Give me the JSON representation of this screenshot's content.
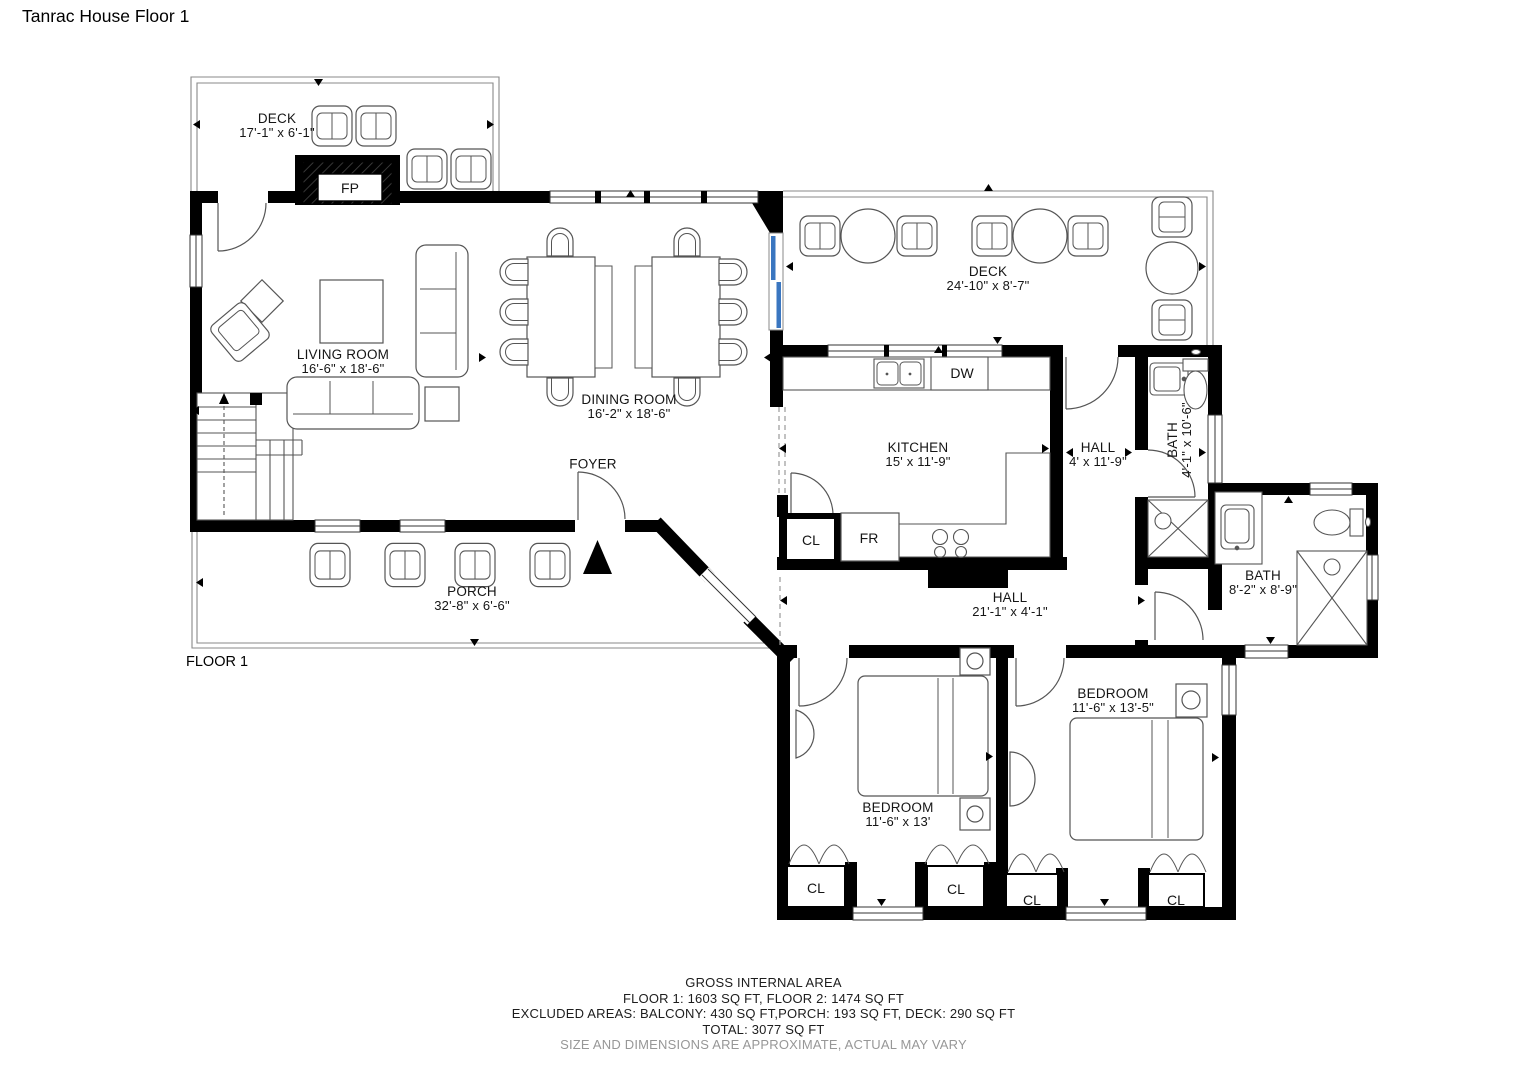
{
  "title": "Tanrac House Floor 1",
  "floor_label": "FLOOR 1",
  "rooms": {
    "deck_top": {
      "name": "DECK",
      "dims": "17'-1\" x 6'-1\""
    },
    "deck_right": {
      "name": "DECK",
      "dims": "24'-10\" x 8'-7\""
    },
    "living": {
      "name": "LIVING ROOM",
      "dims": "16'-6\" x 18'-6\""
    },
    "dining": {
      "name": "DINING ROOM",
      "dims": "16'-2\" x 18'-6\""
    },
    "kitchen": {
      "name": "KITCHEN",
      "dims": "15' x 11'-9\""
    },
    "hall_upper": {
      "name": "HALL",
      "dims": "4' x 11'-9\""
    },
    "bath_upper": {
      "name": "BATH",
      "dims": "4'-1\" x 10'-6\""
    },
    "bath_lower": {
      "name": "BATH",
      "dims": "8'-2\" x 8'-9\""
    },
    "foyer": {
      "name": "FOYER"
    },
    "porch": {
      "name": "PORCH",
      "dims": "32'-8\" x 6'-6\""
    },
    "hall_lower": {
      "name": "HALL",
      "dims": "21'-1\" x 4'-1\""
    },
    "bedroom_left": {
      "name": "BEDROOM",
      "dims": "11'-6\" x 13'"
    },
    "bedroom_right": {
      "name": "BEDROOM",
      "dims": "11'-6\" x 13'-5\""
    }
  },
  "fixtures": {
    "fireplace": "FP",
    "dishwasher": "DW",
    "fridge": "FR",
    "closet": "CL"
  },
  "footer": {
    "line1": "GROSS INTERNAL AREA",
    "line2": "FLOOR 1: 1603 SQ FT, FLOOR 2: 1474 SQ FT",
    "line3": "EXCLUDED AREAS: BALCONY: 430 SQ FT,PORCH: 193 SQ FT, DECK: 290 SQ FT",
    "line4": "TOTAL: 3077 SQ FT",
    "line5": "SIZE AND DIMENSIONS ARE APPROXIMATE, ACTUAL MAY VARY"
  },
  "colors": {
    "wall": "#000000",
    "sliding_door": "#3a76c0",
    "note_gray": "#979797"
  }
}
